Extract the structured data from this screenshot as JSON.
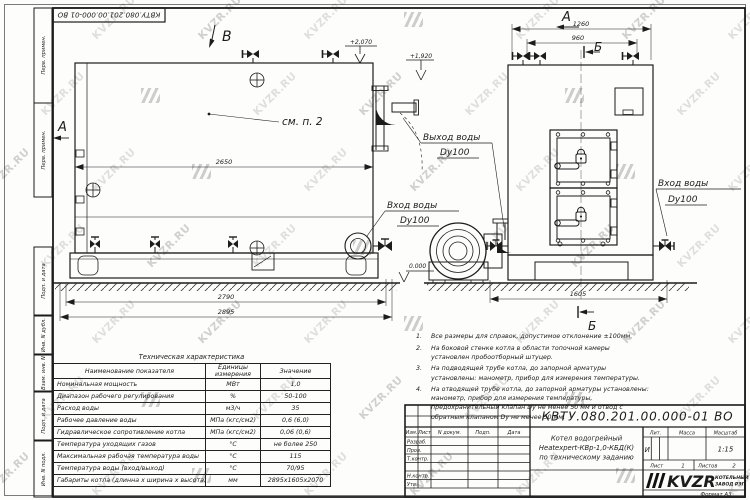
{
  "sheet": {
    "watermark": "KVZR.RU"
  },
  "stamps": {
    "top_designation": "КВТУ.080.201.00.000-01 ВО",
    "left": [
      "Перв. примен.",
      "Перв. примен.",
      "Подп. и дата",
      "Инв. N дубл.",
      "Взам. инв. N",
      "Подп. и дата",
      "Инв. N подл."
    ]
  },
  "drawing": {
    "view_b": "В",
    "view_a_side": "А",
    "view_a_front": "А",
    "section_b": "Б",
    "see_note": "см. п. 2",
    "elev_top": "+2,070",
    "elev_pipe": "+1,920",
    "elev_zero": "0.000",
    "outlet1": "Выход воды",
    "outlet2": "Dy100",
    "inlet1": "Вход воды",
    "inlet2": "Dy100",
    "inlet_r1": "Вход воды",
    "inlet_r2": "Dy100",
    "dim_2650": "2650",
    "dim_2790": "2790",
    "dim_2895": "2895",
    "dim_1260": "1260",
    "dim_960": "960",
    "dim_1605": "1605"
  },
  "table": {
    "title": "Техническая характеристика",
    "headers": [
      "Наименование показателя",
      "Единицы измерения",
      "Значение"
    ],
    "rows": [
      {
        "name": "Номинальная мощность",
        "unit": "МВт",
        "value": "1,0"
      },
      {
        "name": "Диапазон рабочего регулирования",
        "unit": "%",
        "value": "50-100"
      },
      {
        "name": "Расход воды",
        "unit": "м3/ч",
        "value": "35"
      },
      {
        "name": "Рабочее давление воды",
        "unit": "МПа (кгс/см2)",
        "value": "0,6 (6,0)"
      },
      {
        "name": "Гидравлическое сопротивление котла",
        "unit": "МПа (кгс/см2)",
        "value": "0,06 (0,6)"
      },
      {
        "name": "Температура уходящих газов",
        "unit": "°С",
        "value": "не более 250"
      },
      {
        "name": "Максимальная рабочая температура воды",
        "unit": "°С",
        "value": "115"
      },
      {
        "name": "Температура воды (вход/выход)",
        "unit": "°С",
        "value": "70/95"
      },
      {
        "name": "Габариты котла (длинна х ширина х высота)",
        "unit": "мм",
        "value": "2895х1605х2070"
      }
    ]
  },
  "notes": [
    {
      "num": "1.",
      "text": "Все размеры для справок, допустимое отклонение ±100мм."
    },
    {
      "num": "2.",
      "text": "На боковой стенке котла в области топочной камеры установлен пробоотборный штуцер."
    },
    {
      "num": "3.",
      "text": "На подводящей трубе котла, до запорной арматуры установлены: манометр, прибор для измерения температуры."
    },
    {
      "num": "4.",
      "text": "На отводящей трубе котла, до запорной арматуры установлены: манометр, прибор для измерения температуры, предохранительный клапан Dу не менее 50 мм и отвод с обратным клапаном Dу не менее 50 мм."
    }
  ],
  "title_block": {
    "designation": "КВТУ.080.201.00.000-01 ВО",
    "product_line1": "Котел водогрейный",
    "product_line2": "Heatexpert-КВр-1,0-КБД(К)",
    "product_line3": "по техническому заданию",
    "col_izm": "Изм.",
    "col_list": "Лист",
    "col_ndoc": "N докум.",
    "col_podp": "Подп.",
    "col_data": "Дата",
    "staff": [
      "Разраб.",
      "Пров.",
      "Т.контр.",
      "Н.контр.",
      "Утв."
    ],
    "lit_label": "Лит.",
    "lit_value": "И",
    "mass_label": "Масса",
    "scale_label": "Масштаб",
    "scale_value": "1:15",
    "sheet_label": "Лист",
    "sheet_value": "1",
    "sheets_label": "Листов",
    "sheets_value": "2",
    "company_logo": "KVZR",
    "company_name1": "КОТЕЛЬНЫЙ",
    "company_name2": "ЗАВОД РЭП",
    "format": "Формат  А3"
  }
}
